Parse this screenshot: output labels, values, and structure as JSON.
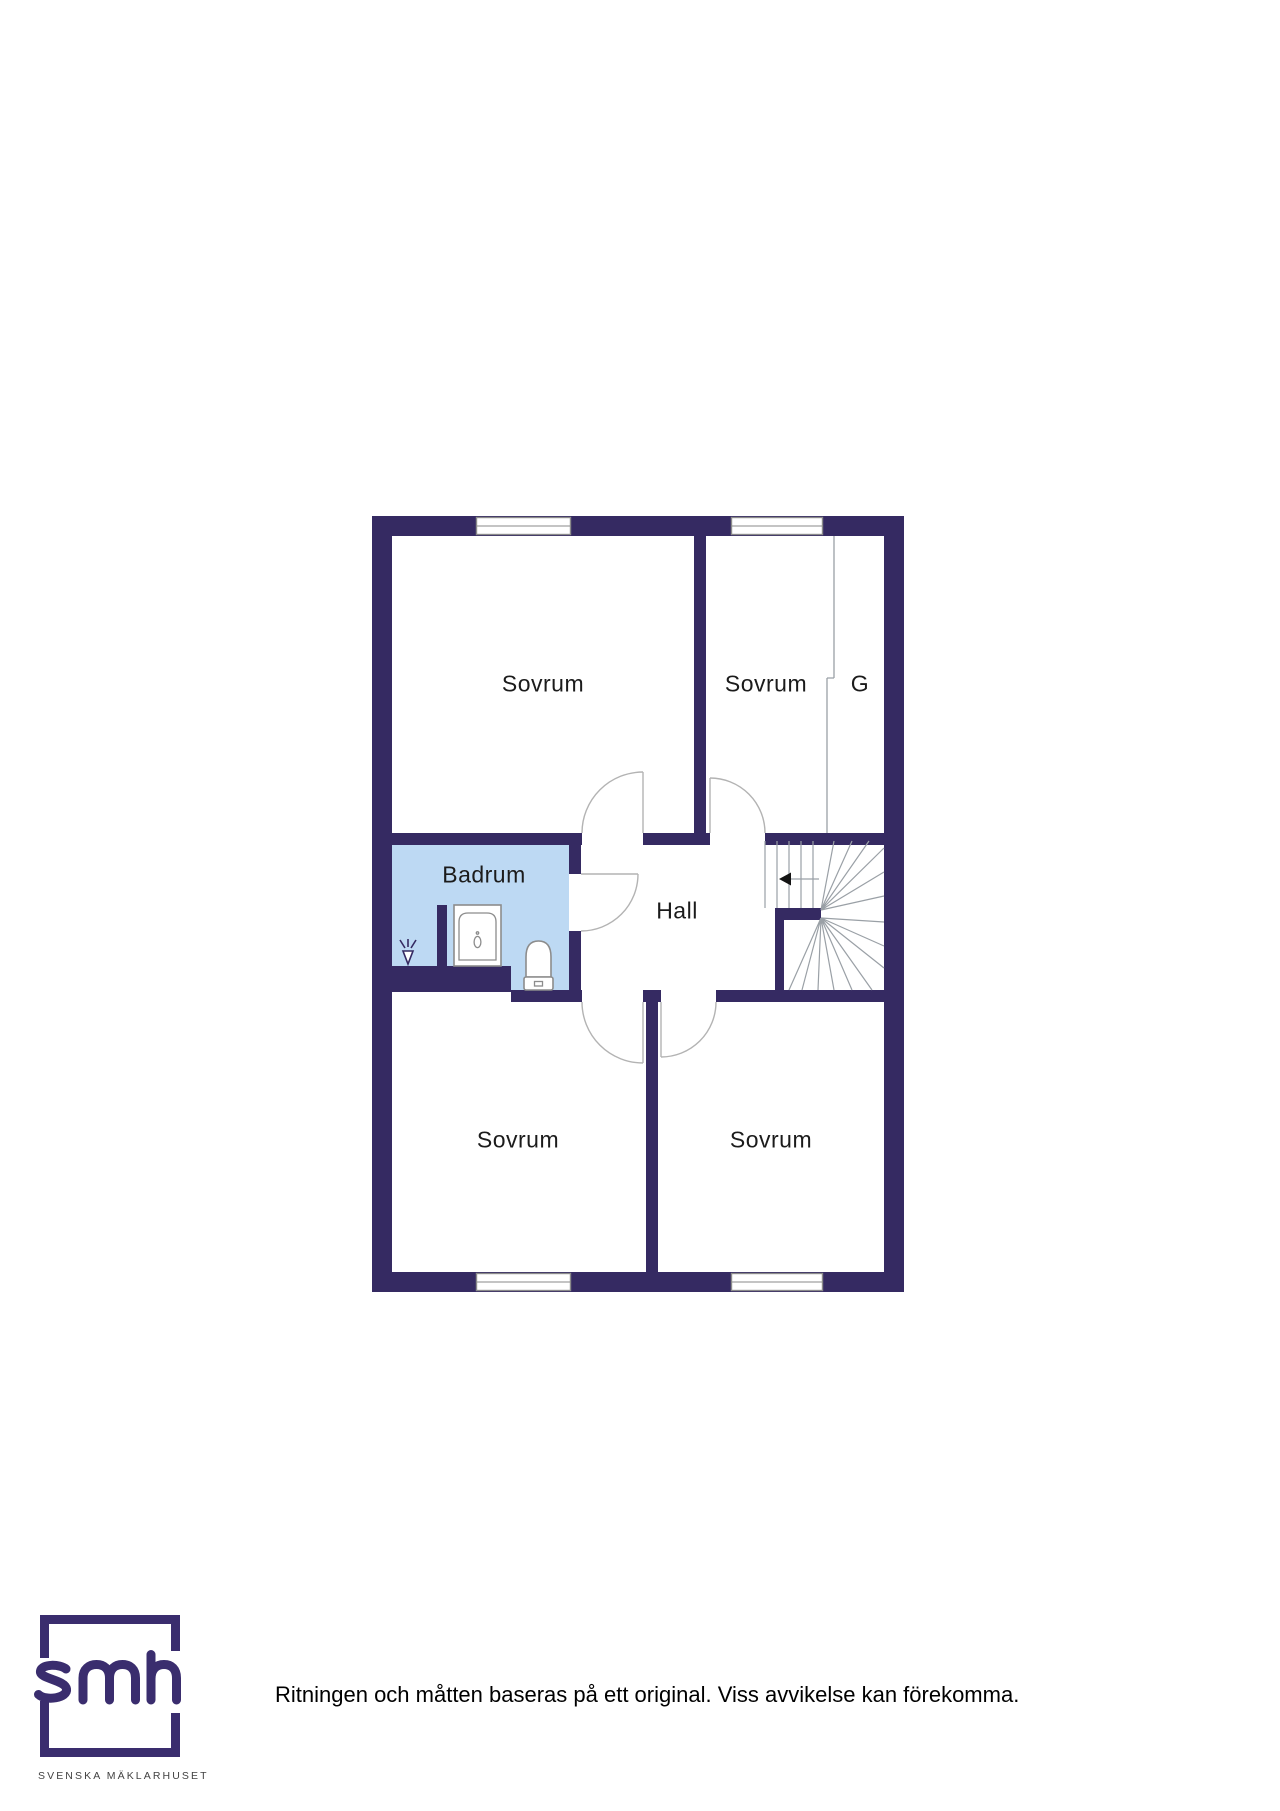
{
  "floorplan": {
    "rooms": [
      {
        "id": "sovrum-top-left",
        "label": "Sovrum"
      },
      {
        "id": "sovrum-top-right",
        "label": "Sovrum"
      },
      {
        "id": "garderob",
        "label": "G"
      },
      {
        "id": "badrum",
        "label": "Badrum"
      },
      {
        "id": "hall",
        "label": "Hall"
      },
      {
        "id": "sovrum-bottom-left",
        "label": "Sovrum"
      },
      {
        "id": "sovrum-bottom-right",
        "label": "Sovrum"
      }
    ]
  },
  "footer": {
    "logo_text": "smh",
    "brand_name": "SVENSKA MÄKLARHUSET",
    "disclaimer": "Ritningen och måtten baseras på ett original. Viss avvikelse kan förekomma."
  },
  "colors": {
    "wall": "#352a62",
    "bathroom_fill": "#bdd9f3",
    "thin_line": "#9aa0a6",
    "door_arc": "#b3b3b3",
    "label_text": "#1b1b1b",
    "logo_purple": "#3a2d6e",
    "brand_text": "#424242",
    "disclaimer_text": "#000000"
  }
}
